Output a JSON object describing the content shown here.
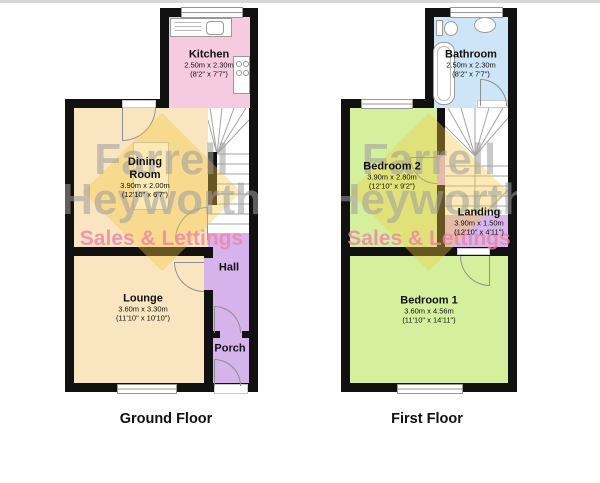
{
  "colors": {
    "wall": "#111111",
    "kitchen": "#F6CADF",
    "dining_room": "#FAE5C1",
    "lounge": "#FAE5C1",
    "hall": "#D6B3EA",
    "porch": "#D6B3EA",
    "bathroom": "#CDE5F7",
    "bedroom_1": "#D5F09D",
    "bedroom_2": "#D5F09D",
    "landing": "#D8B6EC",
    "watermark_text": "#9E9E9E",
    "watermark_accent": "#F4C93F",
    "watermark_tagline": "#EE82A8"
  },
  "watermark": {
    "line1": "Farrell",
    "line2": "Heyworth",
    "tagline": "Sales & Lettings"
  },
  "ground_floor": {
    "title": "Ground Floor",
    "kitchen": {
      "name": "Kitchen",
      "metric": "2.50m x 2.30m",
      "imperial": "(8'2\" x 7'7\")"
    },
    "dining_room": {
      "name": "Dining Room",
      "metric": "3.90m x 2.00m",
      "imperial": "(12'10\" x 6'7\")"
    },
    "lounge": {
      "name": "Lounge",
      "metric": "3.60m x 3.30m",
      "imperial": "(11'10\" x 10'10\")"
    },
    "hall": {
      "name": "Hall"
    },
    "porch": {
      "name": "Porch"
    }
  },
  "first_floor": {
    "title": "First Floor",
    "bathroom": {
      "name": "Bathroom",
      "metric": "2.50m x 2.30m",
      "imperial": "(8'2\" x 7'7\")"
    },
    "bedroom_2": {
      "name": "Bedroom 2",
      "metric": "3.90m x 2.80m",
      "imperial": "(12'10\" x 9'2\")"
    },
    "landing": {
      "name": "Landing",
      "metric": "3.90m x 1.50m",
      "imperial": "(12'10\" x 4'11\")"
    },
    "bedroom_1": {
      "name": "Bedroom 1",
      "metric": "3.60m x 4.56m",
      "imperial": "(11'10\" x 14'11\")"
    }
  }
}
